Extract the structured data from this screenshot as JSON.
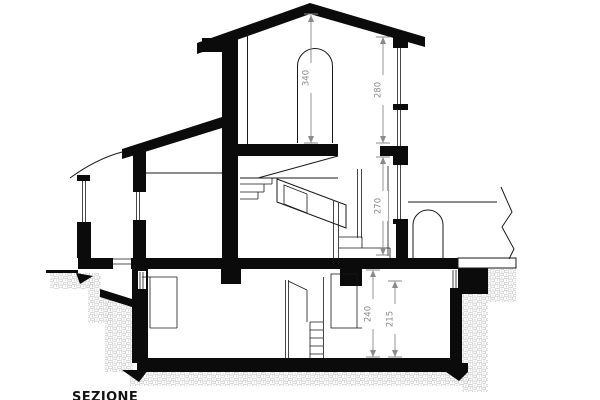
{
  "title": "SEZIONE",
  "drawing_type": "architectural-building-section",
  "dimension_labels": [
    "340",
    "280",
    "270",
    "240",
    "215"
  ],
  "colors": {
    "ink": "#0b0b0b",
    "dimension": "#8a8a8a",
    "hatch": "#c4c4c4",
    "background": "#ffffff"
  }
}
